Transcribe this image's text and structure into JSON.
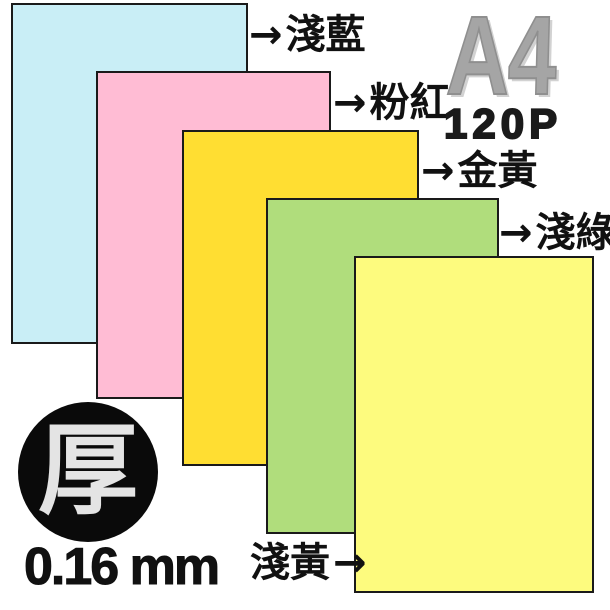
{
  "product": {
    "size": "A4",
    "weight": "120P",
    "thickness_badge": "厚",
    "thickness": "0.16 mm"
  },
  "arrow_glyph": "→",
  "paper_sheets": [
    {
      "id": "light-blue",
      "label": "淺藍",
      "color": "#c9eef6"
    },
    {
      "id": "pink",
      "label": "粉紅",
      "color": "#ffbcd4"
    },
    {
      "id": "gold-yellow",
      "label": "金黃",
      "color": "#ffde32"
    },
    {
      "id": "light-green",
      "label": "淺綠",
      "color": "#b0dd7c"
    },
    {
      "id": "light-yellow",
      "label": "淺黃",
      "color": "#fdfb7e"
    }
  ],
  "ui_colors": {
    "background": "#ffffff",
    "sheet_border": "#1a1a1a",
    "size_text": "#a5a5a5",
    "weight_text": "#1a1a1a",
    "label_text": "#111111",
    "badge_background": "#0a0a0a",
    "badge_text": "#e4e4e4"
  }
}
